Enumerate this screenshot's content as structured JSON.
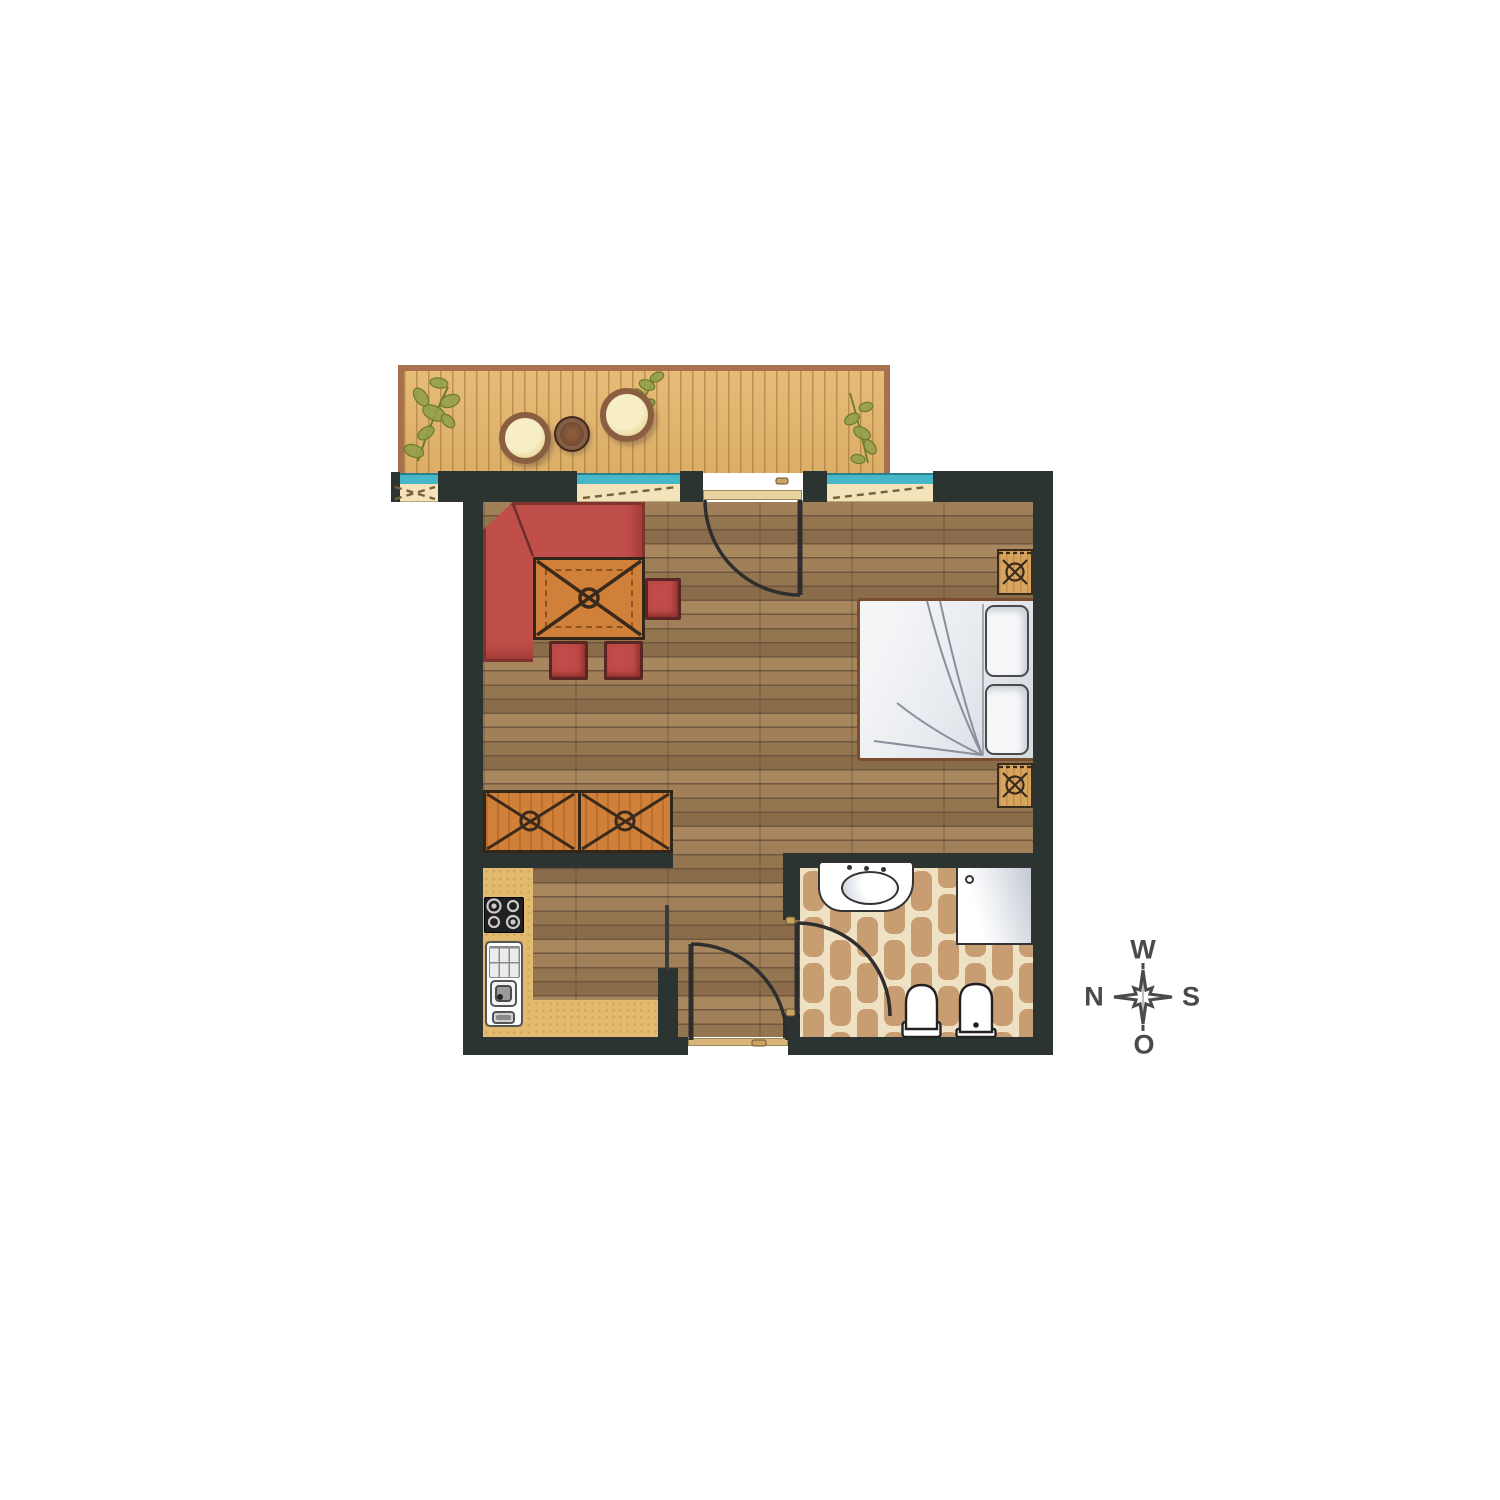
{
  "compass": {
    "top": "W",
    "right": "S",
    "bottom": "O",
    "left": "N"
  },
  "colors": {
    "wall": "#2b3430",
    "floorWood": "#97785a",
    "balconyDeck": "#e0b46e",
    "balconyFrame": "#a8704e",
    "windowGlass": "#45b7c6",
    "windowSill": "#f2e3ba",
    "sofaRed": "#c04f4a",
    "woodOrange": "#d08038",
    "woodOutline": "#32251a",
    "counterTan": "#e3bb70",
    "tileTan": "#c99d72",
    "tileGrout": "#eee1c4",
    "linenWhite": "#eceef1",
    "fixtureOutline": "#333333",
    "doorInk": "#2e2e2e",
    "thresholdGold": "#e6d3a0",
    "compassInk": "#4a4a4a",
    "plantGreen": "#93a04a"
  },
  "icons": {
    "balcony": [
      "plant-icon",
      "egg-chair-icon",
      "round-table-icon",
      "egg-chair-icon",
      "plant-icon"
    ],
    "living_area": [
      "corner-bench-icon",
      "dining-table-icon",
      "stool-icon",
      "stool-icon",
      "stool-icon",
      "wardrobe-icon"
    ],
    "sleeping_area": [
      "double-bed-icon",
      "pillow-icon",
      "pillow-icon",
      "nightstand-icon",
      "nightstand-icon"
    ],
    "kitchen": [
      "counter-icon",
      "stove-icon",
      "kitchen-sink-icon"
    ],
    "bathroom": [
      "vanity-sink-icon",
      "shower-icon",
      "toilet-icon",
      "bidet-icon"
    ],
    "doors": [
      "balcony-door-icon",
      "entrance-door-icon",
      "bathroom-door-icon"
    ],
    "window_count": 3
  }
}
